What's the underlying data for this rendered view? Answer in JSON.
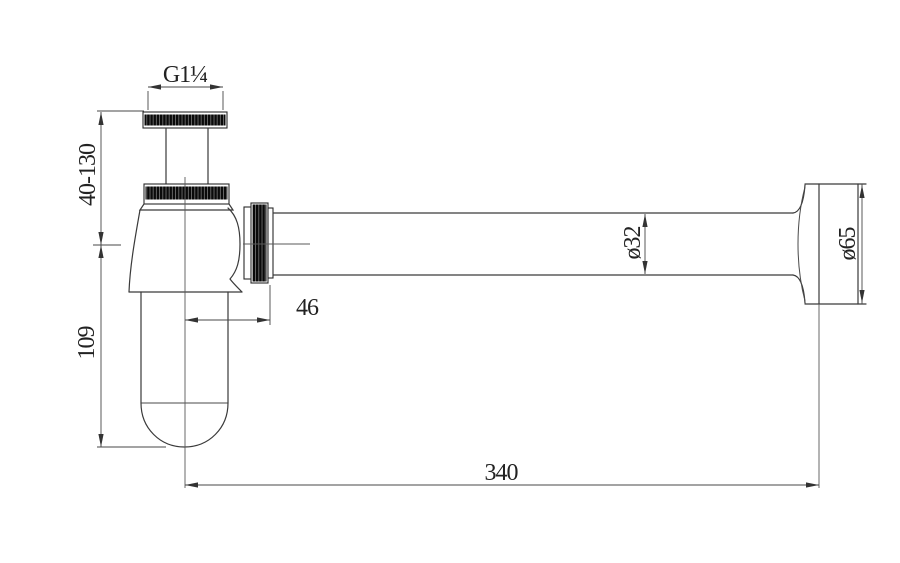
{
  "drawing": {
    "type": "technical-drawing",
    "subject": "bottle-trap-side-view",
    "background_color": "#ffffff",
    "line_color": "#3a3a3a",
    "dimensions": {
      "thread_size": "G1¼",
      "inlet_height_range": "40-130",
      "body_height": "109",
      "outlet_offset": "46",
      "pipe_diameter": "ø32",
      "flange_diameter": "ø65",
      "overall_length": "340"
    }
  }
}
